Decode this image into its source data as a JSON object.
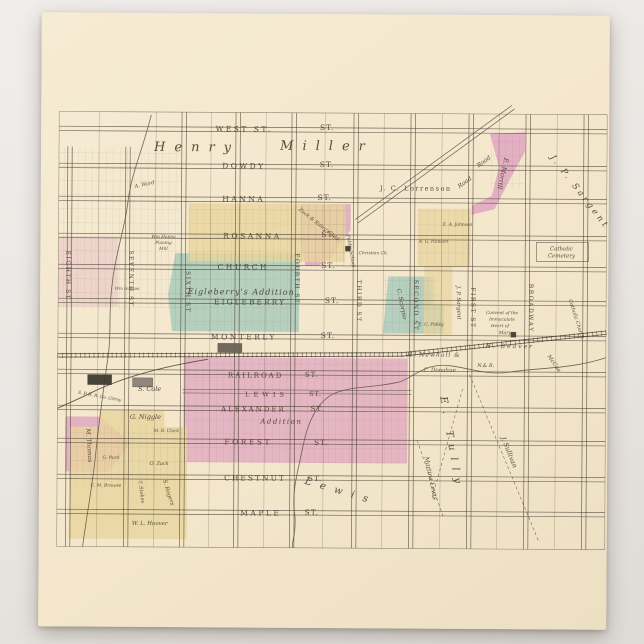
{
  "scene": {
    "background_color": "#e9e5e1"
  },
  "postcard": {
    "paper_color": "#f3e6cb",
    "ink_color": "#4a4034",
    "palette": {
      "pink": "#dfa4bf",
      "teal": "#a6c9ba",
      "yellow": "#e9d49d"
    }
  },
  "map": {
    "grid": {
      "x_min": 58,
      "x_max": 606,
      "y_min": 113,
      "y_max": 548,
      "v_streets": [
        {
          "x": 69,
          "y1": 148
        },
        {
          "x": 127,
          "y1": 148
        },
        {
          "x": 183
        },
        {
          "x": 237
        },
        {
          "x": 293
        },
        {
          "x": 355
        },
        {
          "x": 412
        },
        {
          "x": 470
        },
        {
          "x": 527
        },
        {
          "x": 585
        }
      ],
      "h_streets": [
        130,
        167,
        200,
        237,
        268,
        302,
        337,
        373,
        409,
        442,
        478,
        513
      ],
      "h_partial": [
        {
          "y": 392,
          "x1": 183,
          "x2": 412
        }
      ],
      "v_mid": [
        98,
        155,
        210,
        265,
        324,
        383,
        441,
        498,
        556
      ]
    },
    "regions": [
      {
        "name": "morrill-tract",
        "color": "pink",
        "opacity": 0.85,
        "points": [
          [
            489,
            133
          ],
          [
            524,
            131
          ],
          [
            524,
            150
          ],
          [
            505,
            186
          ],
          [
            494,
            208
          ],
          [
            471,
            214
          ],
          [
            471,
            205
          ],
          [
            491,
            195
          ],
          [
            498,
            166
          ]
        ]
      },
      {
        "name": "zuck-raley-addition",
        "color": "pink",
        "opacity": 0.8,
        "points": [
          [
            300,
            204
          ],
          [
            350,
            204
          ],
          [
            350,
            230
          ],
          [
            331,
            257
          ],
          [
            318,
            266
          ],
          [
            305,
            266
          ],
          [
            300,
            240
          ]
        ]
      },
      {
        "name": "south-addition",
        "color": "pink",
        "opacity": 0.72,
        "points": [
          [
            184,
            358
          ],
          [
            408,
            358
          ],
          [
            408,
            463
          ],
          [
            184,
            463
          ]
        ]
      },
      {
        "name": "thomas-tract",
        "color": "pink",
        "opacity": 0.8,
        "points": [
          [
            66,
            418
          ],
          [
            100,
            418
          ],
          [
            132,
            444
          ],
          [
            110,
            473
          ],
          [
            66,
            473
          ]
        ]
      },
      {
        "name": "west-pink-strips",
        "color": "pink",
        "opacity": 0.3,
        "points": [
          [
            58,
            238
          ],
          [
            118,
            238
          ],
          [
            118,
            308
          ],
          [
            58,
            308
          ]
        ]
      },
      {
        "name": "eigleberry-addition-area",
        "color": "teal",
        "opacity": 0.8,
        "points": [
          [
            175,
            254
          ],
          [
            299,
            254
          ],
          [
            299,
            332
          ],
          [
            172,
            332
          ],
          [
            168,
            295
          ]
        ]
      },
      {
        "name": "scorpio-tract",
        "color": "teal",
        "opacity": 0.8,
        "points": [
          [
            388,
            276
          ],
          [
            433,
            276
          ],
          [
            433,
            304
          ],
          [
            444,
            304
          ],
          [
            444,
            333
          ],
          [
            383,
            333
          ]
        ]
      },
      {
        "name": "north-yellow-blocks",
        "color": "yellow",
        "opacity": 0.8,
        "points": [
          [
            188,
            204
          ],
          [
            345,
            204
          ],
          [
            345,
            262
          ],
          [
            188,
            262
          ]
        ]
      },
      {
        "name": "johnson-hanson-blocks",
        "color": "yellow",
        "opacity": 0.75,
        "points": [
          [
            417,
            208
          ],
          [
            470,
            208
          ],
          [
            470,
            266
          ],
          [
            417,
            266
          ]
        ]
      },
      {
        "name": "first-street-yellow",
        "color": "yellow",
        "opacity": 0.7,
        "points": [
          [
            424,
            266
          ],
          [
            452,
            266
          ],
          [
            452,
            334
          ],
          [
            424,
            334
          ]
        ]
      },
      {
        "name": "southwest-yellow-blocks",
        "color": "yellow",
        "opacity": 0.8,
        "points": [
          [
            70,
            428
          ],
          [
            100,
            428
          ],
          [
            100,
            412
          ],
          [
            165,
            412
          ],
          [
            165,
            428
          ],
          [
            188,
            428
          ],
          [
            188,
            540
          ],
          [
            70,
            540
          ]
        ]
      }
    ],
    "lot_texture_rects": [
      [
        58,
        150,
        122,
        160
      ],
      [
        188,
        205,
        157,
        57
      ],
      [
        184,
        358,
        224,
        105
      ],
      [
        417,
        208,
        53,
        58
      ],
      [
        300,
        204,
        50,
        62
      ],
      [
        175,
        254,
        124,
        78
      ],
      [
        490,
        133,
        33,
        55
      ],
      [
        70,
        428,
        118,
        60
      ],
      [
        383,
        276,
        60,
        57
      ]
    ],
    "boxes": [
      [
        536,
        241,
        52,
        19
      ]
    ],
    "railroad": {
      "main": [
        [
          58,
          357
        ],
        [
          402,
          354
        ],
        [
          606,
          331
        ]
      ],
      "spur": "M 208,360 C 160,368 120,380 92,394 C 76,402 66,406 58,410"
    },
    "creeks": [
      "M 150,116 C 142,150 130,175 127,205 C 123,235 115,255 112,285 C 108,315 112,335 108,360 C 104,390 100,420 97,450 C 94,485 88,515 84,548",
      "M 606,356 C 570,368 540,366 510,371 C 480,376 455,360 432,366 C 415,371 408,380 398,382 C 370,388 345,386 330,396 C 315,406 308,425 304,445 C 300,468 292,490 296,515 C 298,535 292,545 294,548"
    ],
    "roads": [
      {
        "name": "diagonal-road",
        "x1": 512,
        "y1": 106,
        "x2": 356,
        "y2": 221
      }
    ],
    "dashed_lines": [
      [
        470,
        374,
        540,
        540
      ],
      [
        418,
        440,
        444,
        515
      ],
      [
        463,
        388,
        433,
        498
      ]
    ],
    "buildings": [
      {
        "x": 88,
        "y": 376,
        "w": 24,
        "h": 10,
        "fill": "#3f3a33"
      },
      {
        "x": 133,
        "y": 379,
        "w": 20,
        "h": 9,
        "fill": "#8a8178"
      },
      {
        "x": 218,
        "y": 344,
        "w": 24,
        "h": 9,
        "fill": "#6b6257"
      },
      {
        "x": 511,
        "y": 331,
        "w": 5,
        "h": 5,
        "fill": "#3f3a33"
      },
      {
        "x": 345,
        "y": 246,
        "w": 5,
        "h": 5,
        "fill": "#3f3a33"
      }
    ],
    "labels": [
      {
        "t": "WEST ST.",
        "x": 243,
        "y": 132,
        "s": 7.5,
        "ls": 2.5
      },
      {
        "t": "ST.",
        "x": 326,
        "y": 130,
        "s": 7.5,
        "ls": 1
      },
      {
        "t": "DOWDY",
        "x": 243,
        "y": 169,
        "s": 7.5,
        "ls": 2.5
      },
      {
        "t": "ST.",
        "x": 326,
        "y": 167,
        "s": 7.5,
        "ls": 1
      },
      {
        "t": "HANNA",
        "x": 243,
        "y": 202,
        "s": 7.5,
        "ls": 2.5
      },
      {
        "t": "ST.",
        "x": 324,
        "y": 200,
        "s": 7.5,
        "ls": 1
      },
      {
        "t": "ROSANNA",
        "x": 252,
        "y": 239,
        "s": 7.5,
        "ls": 2.5
      },
      {
        "t": "ST.",
        "x": 328,
        "y": 237,
        "s": 7.5,
        "ls": 1
      },
      {
        "t": "CHURCH",
        "x": 243,
        "y": 270,
        "s": 7.5,
        "ls": 2.5
      },
      {
        "t": "ST.",
        "x": 328,
        "y": 268,
        "s": 7.5,
        "ls": 1
      },
      {
        "t": "EIGLEBERRY",
        "x": 250,
        "y": 305,
        "s": 7.5,
        "ls": 2
      },
      {
        "t": "ST.",
        "x": 332,
        "y": 303,
        "s": 7.5,
        "ls": 1
      },
      {
        "t": "MONTERLY",
        "x": 244,
        "y": 340,
        "s": 7.5,
        "ls": 2.5
      },
      {
        "t": "ST.",
        "x": 328,
        "y": 338,
        "s": 7.5,
        "ls": 1
      },
      {
        "t": "RAILROAD",
        "x": 256,
        "y": 378,
        "s": 7,
        "ls": 2
      },
      {
        "t": "ST.",
        "x": 312,
        "y": 377,
        "s": 7,
        "ls": 1
      },
      {
        "t": "LEWIS",
        "x": 267,
        "y": 397,
        "s": 6.5,
        "ls": 4
      },
      {
        "t": "ST.",
        "x": 316,
        "y": 396,
        "s": 6.5,
        "ls": 1
      },
      {
        "t": "ALEXANDER",
        "x": 254,
        "y": 412,
        "s": 7,
        "ls": 2
      },
      {
        "t": "ST.",
        "x": 318,
        "y": 411,
        "s": 7,
        "ls": 1
      },
      {
        "t": "Addition",
        "x": 282,
        "y": 424,
        "s": 7,
        "i": 1,
        "ls": 1.5
      },
      {
        "t": "FOREST",
        "x": 249,
        "y": 445,
        "s": 7.5,
        "ls": 2.5
      },
      {
        "t": "ST.",
        "x": 322,
        "y": 445,
        "s": 7.5,
        "ls": 1
      },
      {
        "t": "CHESTNUT",
        "x": 256,
        "y": 481,
        "s": 7.5,
        "ls": 2
      },
      {
        "t": "ST.",
        "x": 316,
        "y": 481,
        "s": 7.5,
        "ls": 1
      },
      {
        "t": "MAPLE",
        "x": 262,
        "y": 516,
        "s": 7.5,
        "ls": 2.5
      },
      {
        "t": "ST.",
        "x": 313,
        "y": 515,
        "s": 7.5,
        "ls": 1
      },
      {
        "t": "EIGHTH ST",
        "x": 66,
        "y": 277,
        "s": 6,
        "r": 90,
        "ls": 1.5
      },
      {
        "t": "SEVENTH ST",
        "x": 129,
        "y": 280,
        "s": 6,
        "r": 90,
        "ls": 1.5
      },
      {
        "t": "SIXTH ST",
        "x": 186,
        "y": 293,
        "s": 6,
        "r": 90,
        "ls": 1.5
      },
      {
        "t": "FOURTH ST",
        "x": 295,
        "y": 279,
        "s": 6,
        "r": 90,
        "ls": 1.5
      },
      {
        "t": "THIRD ST",
        "x": 357,
        "y": 301,
        "s": 6,
        "r": 90,
        "ls": 1.5
      },
      {
        "t": "SECOND ST",
        "x": 414,
        "y": 305,
        "s": 6,
        "r": 90,
        "ls": 1.5
      },
      {
        "t": "FIRST ST",
        "x": 471,
        "y": 307,
        "s": 6,
        "r": 90,
        "ls": 1.5
      },
      {
        "t": "BROADWAY",
        "x": 529,
        "y": 307,
        "s": 6,
        "r": 90,
        "ls": 1.5
      },
      {
        "t": "Henry",
        "x": 196,
        "y": 152,
        "s": 13,
        "i": 1,
        "ls": 9
      },
      {
        "t": "Miller",
        "x": 326,
        "y": 150,
        "s": 13,
        "i": 1,
        "ls": 9
      },
      {
        "t": "J. C. Lorrenson",
        "x": 415,
        "y": 190,
        "s": 6.5,
        "ls": 1.5
      },
      {
        "t": "J. P. Sargent",
        "x": 577,
        "y": 192,
        "s": 8.5,
        "i": 1,
        "r": 52,
        "ls": 3
      },
      {
        "t": "E. Morrill",
        "x": 500,
        "y": 172,
        "s": 6.5,
        "i": 1,
        "r": 102
      },
      {
        "t": "Road",
        "x": 484,
        "y": 162,
        "s": 6,
        "i": 1,
        "r": -37
      },
      {
        "t": "Road",
        "x": 465,
        "y": 183,
        "s": 6,
        "i": 1,
        "r": -37
      },
      {
        "t": "Catholic",
        "x": 561,
        "y": 249,
        "s": 5.5,
        "i": 1
      },
      {
        "t": "Cemetery",
        "x": 561,
        "y": 256,
        "s": 5.5,
        "i": 1
      },
      {
        "t": "Convent of the",
        "x": 502,
        "y": 313,
        "s": 4.3,
        "i": 1
      },
      {
        "t": "Immaculate",
        "x": 502,
        "y": 319.5,
        "s": 4.3,
        "i": 1
      },
      {
        "t": "Heart of",
        "x": 500,
        "y": 326,
        "s": 4.3,
        "i": 1
      },
      {
        "t": "Mary",
        "x": 505,
        "y": 333,
        "s": 4.6,
        "i": 1
      },
      {
        "t": "Catholic Church",
        "x": 575,
        "y": 318,
        "s": 5,
        "i": 1,
        "r": 72
      },
      {
        "t": "J. P. Sargent",
        "x": 457,
        "y": 302,
        "s": 5.5,
        "i": 1,
        "r": 88
      },
      {
        "t": "E. A. Johnson",
        "x": 457,
        "y": 225,
        "s": 4.4,
        "i": 1
      },
      {
        "t": "A. G. Hanson",
        "x": 433,
        "y": 242,
        "s": 4.4,
        "i": 1
      },
      {
        "t": "Christian Ch.",
        "x": 373,
        "y": 254,
        "s": 4.4,
        "i": 1
      },
      {
        "t": "Public School",
        "x": 349,
        "y": 251,
        "s": 4.8,
        "i": 1,
        "r": 80
      },
      {
        "t": "Zuck & Raley's Add.",
        "x": 318,
        "y": 226,
        "s": 5,
        "i": 1,
        "r": 38
      },
      {
        "t": "Wm Hanna",
        "x": 163,
        "y": 239,
        "s": 4.3,
        "i": 1
      },
      {
        "t": "Planing",
        "x": 163,
        "y": 245,
        "s": 4.3,
        "i": 1
      },
      {
        "t": "Mill",
        "x": 163,
        "y": 251,
        "s": 4.3,
        "i": 1
      },
      {
        "t": "Wm Hanson",
        "x": 127,
        "y": 291,
        "s": 4,
        "i": 1
      },
      {
        "t": "A. Ward",
        "x": 144,
        "y": 187,
        "s": 5,
        "i": 1,
        "r": -12
      },
      {
        "t": "Eigleberry's Addition",
        "x": 241,
        "y": 295,
        "s": 8,
        "i": 1,
        "ls": 1
      },
      {
        "t": "C. Scorpio",
        "x": 400,
        "y": 304,
        "s": 6,
        "i": 1,
        "r": 78
      },
      {
        "t": "E. C. Polley",
        "x": 431,
        "y": 325,
        "s": 4.4,
        "i": 1
      },
      {
        "t": "H. Newhall &",
        "x": 434,
        "y": 356,
        "s": 6,
        "i": 1,
        "ls": 1
      },
      {
        "t": "C. Donahue",
        "x": 440,
        "y": 371,
        "s": 5.5,
        "i": 1
      },
      {
        "t": "N.& B.",
        "x": 486,
        "y": 366,
        "s": 5,
        "i": 1
      },
      {
        "t": "H. Beaver",
        "x": 510,
        "y": 347,
        "s": 6,
        "i": 1,
        "ls": 2
      },
      {
        "t": "McCue",
        "x": 553,
        "y": 363,
        "s": 5.5,
        "i": 1,
        "r": 55
      },
      {
        "t": "E. Tully",
        "x": 449,
        "y": 443,
        "s": 10,
        "i": 1,
        "r": 80,
        "ls": 7
      },
      {
        "t": "J. Sullivan",
        "x": 508,
        "y": 452,
        "s": 6.5,
        "i": 1,
        "r": 68
      },
      {
        "t": "Martina Lewis",
        "x": 430,
        "y": 478,
        "s": 6,
        "i": 1,
        "r": 78
      },
      {
        "t": "Lewis",
        "x": 341,
        "y": 494,
        "s": 10,
        "i": 1,
        "r": 16,
        "ls": 9
      },
      {
        "t": "S. Cole",
        "x": 150,
        "y": 392,
        "s": 6.5,
        "i": 1
      },
      {
        "t": "G. Niggle",
        "x": 146,
        "y": 420,
        "s": 6.5,
        "i": 1
      },
      {
        "t": "M. B. Clark",
        "x": 167,
        "y": 433,
        "s": 4.4,
        "i": 1
      },
      {
        "t": "O. Zack",
        "x": 160,
        "y": 466,
        "s": 5,
        "i": 1
      },
      {
        "t": "G. Buck",
        "x": 112,
        "y": 460,
        "s": 4.4,
        "i": 1
      },
      {
        "t": "C. M. Browne",
        "x": 107,
        "y": 488,
        "s": 4.4,
        "i": 1
      },
      {
        "t": "T. Stokes",
        "x": 141,
        "y": 493,
        "s": 5,
        "i": 1,
        "r": 82
      },
      {
        "t": "S. Rogers",
        "x": 168,
        "y": 494,
        "s": 5.5,
        "i": 1,
        "r": 72
      },
      {
        "t": "W. L. Hoover",
        "x": 151,
        "y": 526,
        "s": 5.5,
        "i": 1
      },
      {
        "t": "M. Thomas",
        "x": 88,
        "y": 447,
        "s": 6,
        "i": 1,
        "r": 86
      },
      {
        "t": "S. P. R. R. Co. Gilroy",
        "x": 100,
        "y": 399,
        "s": 4.3,
        "i": 1,
        "r": 10
      }
    ]
  }
}
